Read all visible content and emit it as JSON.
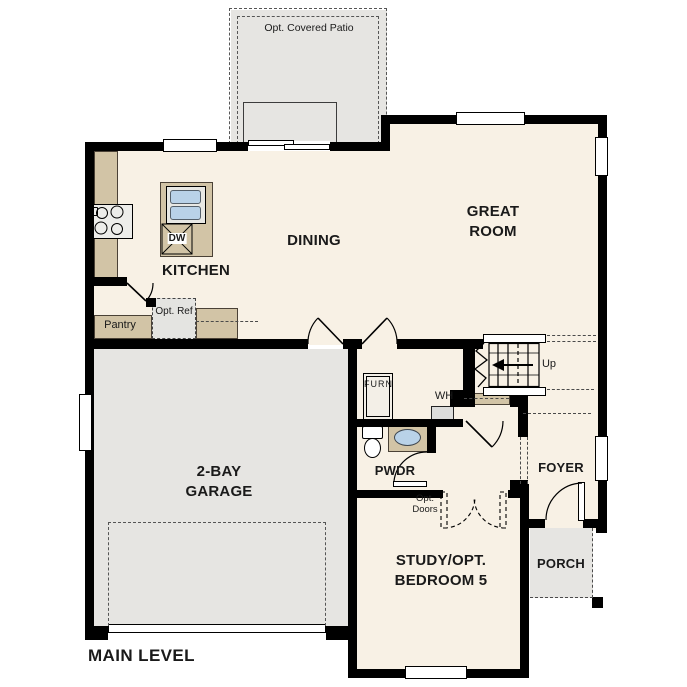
{
  "plan": {
    "level_label": "MAIN LEVEL"
  },
  "rooms": {
    "kitchen": {
      "label": "KITCHEN"
    },
    "dining": {
      "label": "DINING"
    },
    "great_room": {
      "line1": "GREAT",
      "line2": "ROOM"
    },
    "garage": {
      "line1": "2-BAY",
      "line2": "GARAGE"
    },
    "study": {
      "line1": "STUDY/OPT.",
      "line2": "BEDROOM 5"
    },
    "foyer": {
      "label": "FOYER"
    },
    "porch": {
      "label": "PORCH"
    },
    "powder_room": {
      "label": "PWDR"
    },
    "pantry": {
      "label": "Pantry"
    }
  },
  "features": {
    "covered_patio": {
      "label": "Opt. Covered Patio"
    },
    "optional_refrigerator": {
      "line1": "Opt.",
      "line2": "Ref"
    },
    "optional_doors": {
      "line1": "Opt.",
      "line2": "Doors"
    },
    "dishwasher": {
      "label": "DW"
    },
    "furnace": {
      "label": "FURN"
    },
    "water_heater": {
      "label": "WH"
    },
    "stairs_direction": {
      "label": "Up"
    }
  },
  "colors": {
    "floor": "#f8f1e5",
    "concrete": "#e6e5e2",
    "counter": "#d2c4a6",
    "wall": "#000000",
    "water": "#b9d2e8",
    "text": "#1a1a1a"
  }
}
